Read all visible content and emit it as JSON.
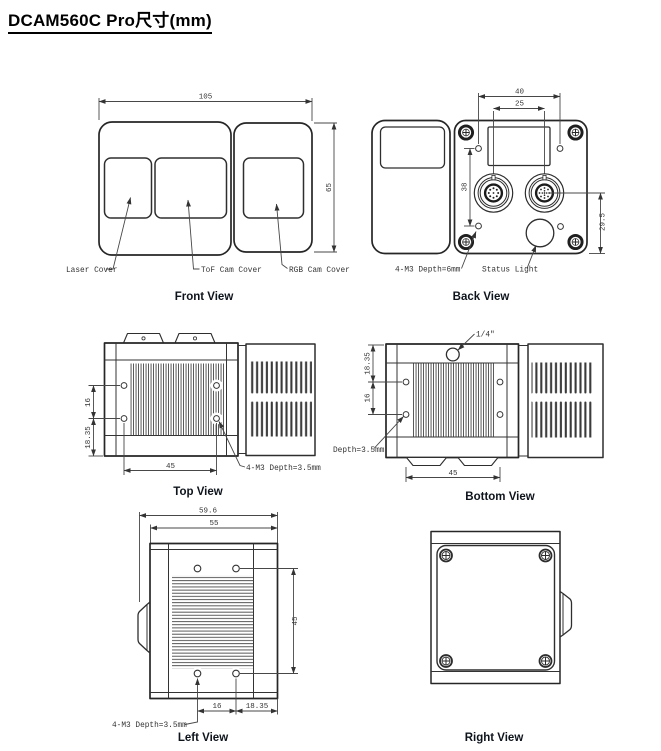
{
  "title": "DCAM560C Pro尺寸(mm)",
  "colors": {
    "line": "#262626",
    "dim_text": "#333333",
    "caption": "#0e141c"
  },
  "front": {
    "caption": "Front View",
    "dim_width": "105",
    "dim_height": "65",
    "label_laser": "Laser Cover",
    "label_tof": "ToF Cam Cover",
    "label_rgb": "RGB Cam Cover"
  },
  "back": {
    "caption": "Back View",
    "dim_top": "40",
    "dim_inner": "25",
    "dim_left": "38",
    "dim_right": "29.5",
    "label_m3": "4-M3 Depth=6mm",
    "label_status": "Status Light"
  },
  "top": {
    "caption": "Top View",
    "dim_v1": "16",
    "dim_v2": "18.35",
    "dim_h": "45",
    "label_m3": "4-M3 Depth=3.5mm"
  },
  "bottom": {
    "caption": "Bottom View",
    "dim_v1": "18.35",
    "dim_v2": "16",
    "dim_h": "45",
    "label_quarter": "1/4\"",
    "label_depth": "Depth=3.5mm"
  },
  "left": {
    "caption": "Left View",
    "dim_w1": "59.6",
    "dim_w2": "55",
    "dim_v": "45",
    "dim_b1": "16",
    "dim_b2": "18.35",
    "label_m3": "4-M3 Depth=3.5mm"
  },
  "right": {
    "caption": "Right View"
  }
}
